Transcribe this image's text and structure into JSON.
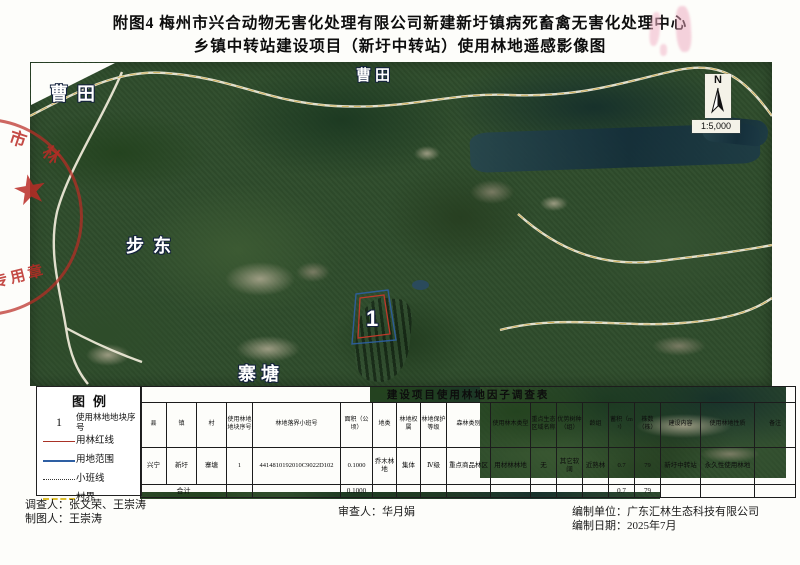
{
  "page": {
    "title_line1": "附图4 梅州市兴合动物无害化处理有限公司新建新圩镇病死畜禽无害化处理中心",
    "title_line2": "乡镇中转站建设项目（新圩中转站）使用林地遥感影像图"
  },
  "map": {
    "place_labels": {
      "caotian_left": "曹田",
      "caotian_top": "曹田",
      "budong": "步东",
      "zhaitang": "寨塘"
    },
    "plot_marker": "1",
    "compass": {
      "north": "N",
      "scale": "1:5,000"
    },
    "stamp": {
      "char_top": "市",
      "char_mid": "林",
      "char_bottom": "专用章",
      "star": "★"
    },
    "colors": {
      "forest_redline": "#c0392b",
      "land_extent_blue": "#2e5fa3",
      "village_boundary_yellow": "#ddbe2f"
    }
  },
  "legend": {
    "title": "图例",
    "items": [
      {
        "symbol": "plot-number",
        "symbol_text": "1",
        "label": "使用林地地块序号"
      },
      {
        "symbol": "red-line",
        "label": "用林红线"
      },
      {
        "symbol": "blue-line",
        "label": "用地范围"
      },
      {
        "symbol": "dotted-line",
        "label": "小班线"
      },
      {
        "symbol": "yellow-dashed-line",
        "label": "村界"
      }
    ]
  },
  "table": {
    "title": "建设项目使用林地因子调查表",
    "columns": [
      "县",
      "镇",
      "村",
      "使用林地地块序号",
      "林地落界小班号",
      "面积（公顷）",
      "地类",
      "林地权属",
      "林地保护等级",
      "森林类别",
      "使用林木类型",
      "重点生态区域名称",
      "优势树种（组）",
      "龄组",
      "蓄积（m³）",
      "株数（株）",
      "建设内容",
      "使用林地性质",
      "备注"
    ],
    "row": [
      "兴宁",
      "新圩",
      "寨塘",
      "1",
      "4414810192010C9022D102",
      "0.1000",
      "乔木林地",
      "集体",
      "Ⅳ级",
      "重点商品林区",
      "用材林林地",
      "无",
      "其它软阔",
      "近熟林",
      "0.7",
      "79",
      "新圩中转站",
      "永久性使用林地",
      ""
    ],
    "total": {
      "label": "合计",
      "area": "0.1000",
      "volume": "0.7",
      "trees": "79"
    }
  },
  "footer": {
    "surveyor": "调查人：张文荣、王崇涛",
    "cartographer": "制图人：王崇涛",
    "reviewer": "审查人：华月娟",
    "compiler": "编制单位：广东汇林生态科技有限公司",
    "date": "编制日期：2025年7月"
  }
}
